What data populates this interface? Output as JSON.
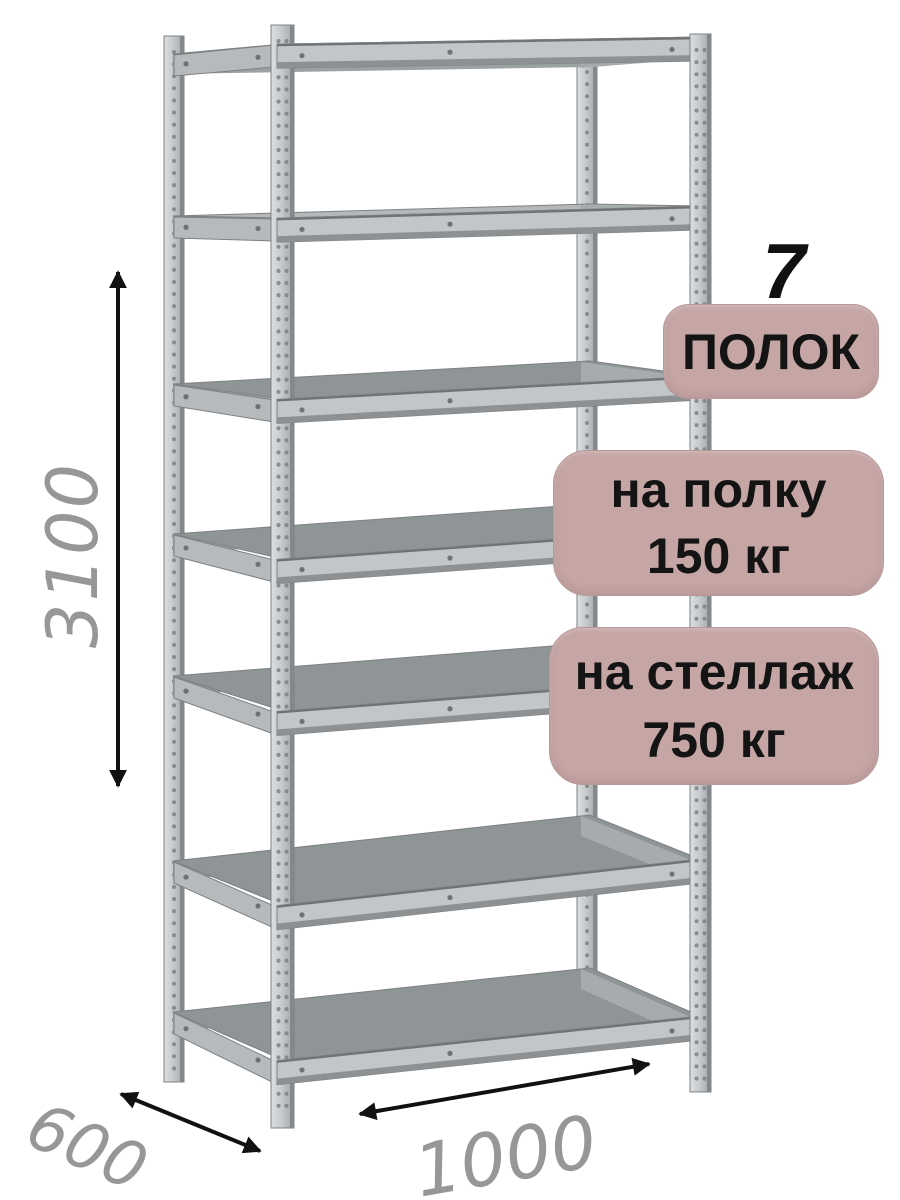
{
  "product": {
    "name": "metal-shelving-rack"
  },
  "annotations": {
    "shelf_count_number": "7",
    "shelf_count_label": "ПОЛОК",
    "shelf_load": {
      "line1": "на полку",
      "line2": "150 кг"
    },
    "rack_load": {
      "line1": "на стеллаж",
      "line2": "750 кг"
    }
  },
  "dimensions": {
    "height_mm": "3100",
    "depth_mm": "600",
    "width_mm": "1000"
  },
  "colors": {
    "badge_bg": "#c6a5a5",
    "badge_border": "#b79797",
    "badge_text": "#141414",
    "accent_number": "#111111",
    "dimension_text": "#979797",
    "arrow": "#111111",
    "page_bg": "#ffffff"
  }
}
